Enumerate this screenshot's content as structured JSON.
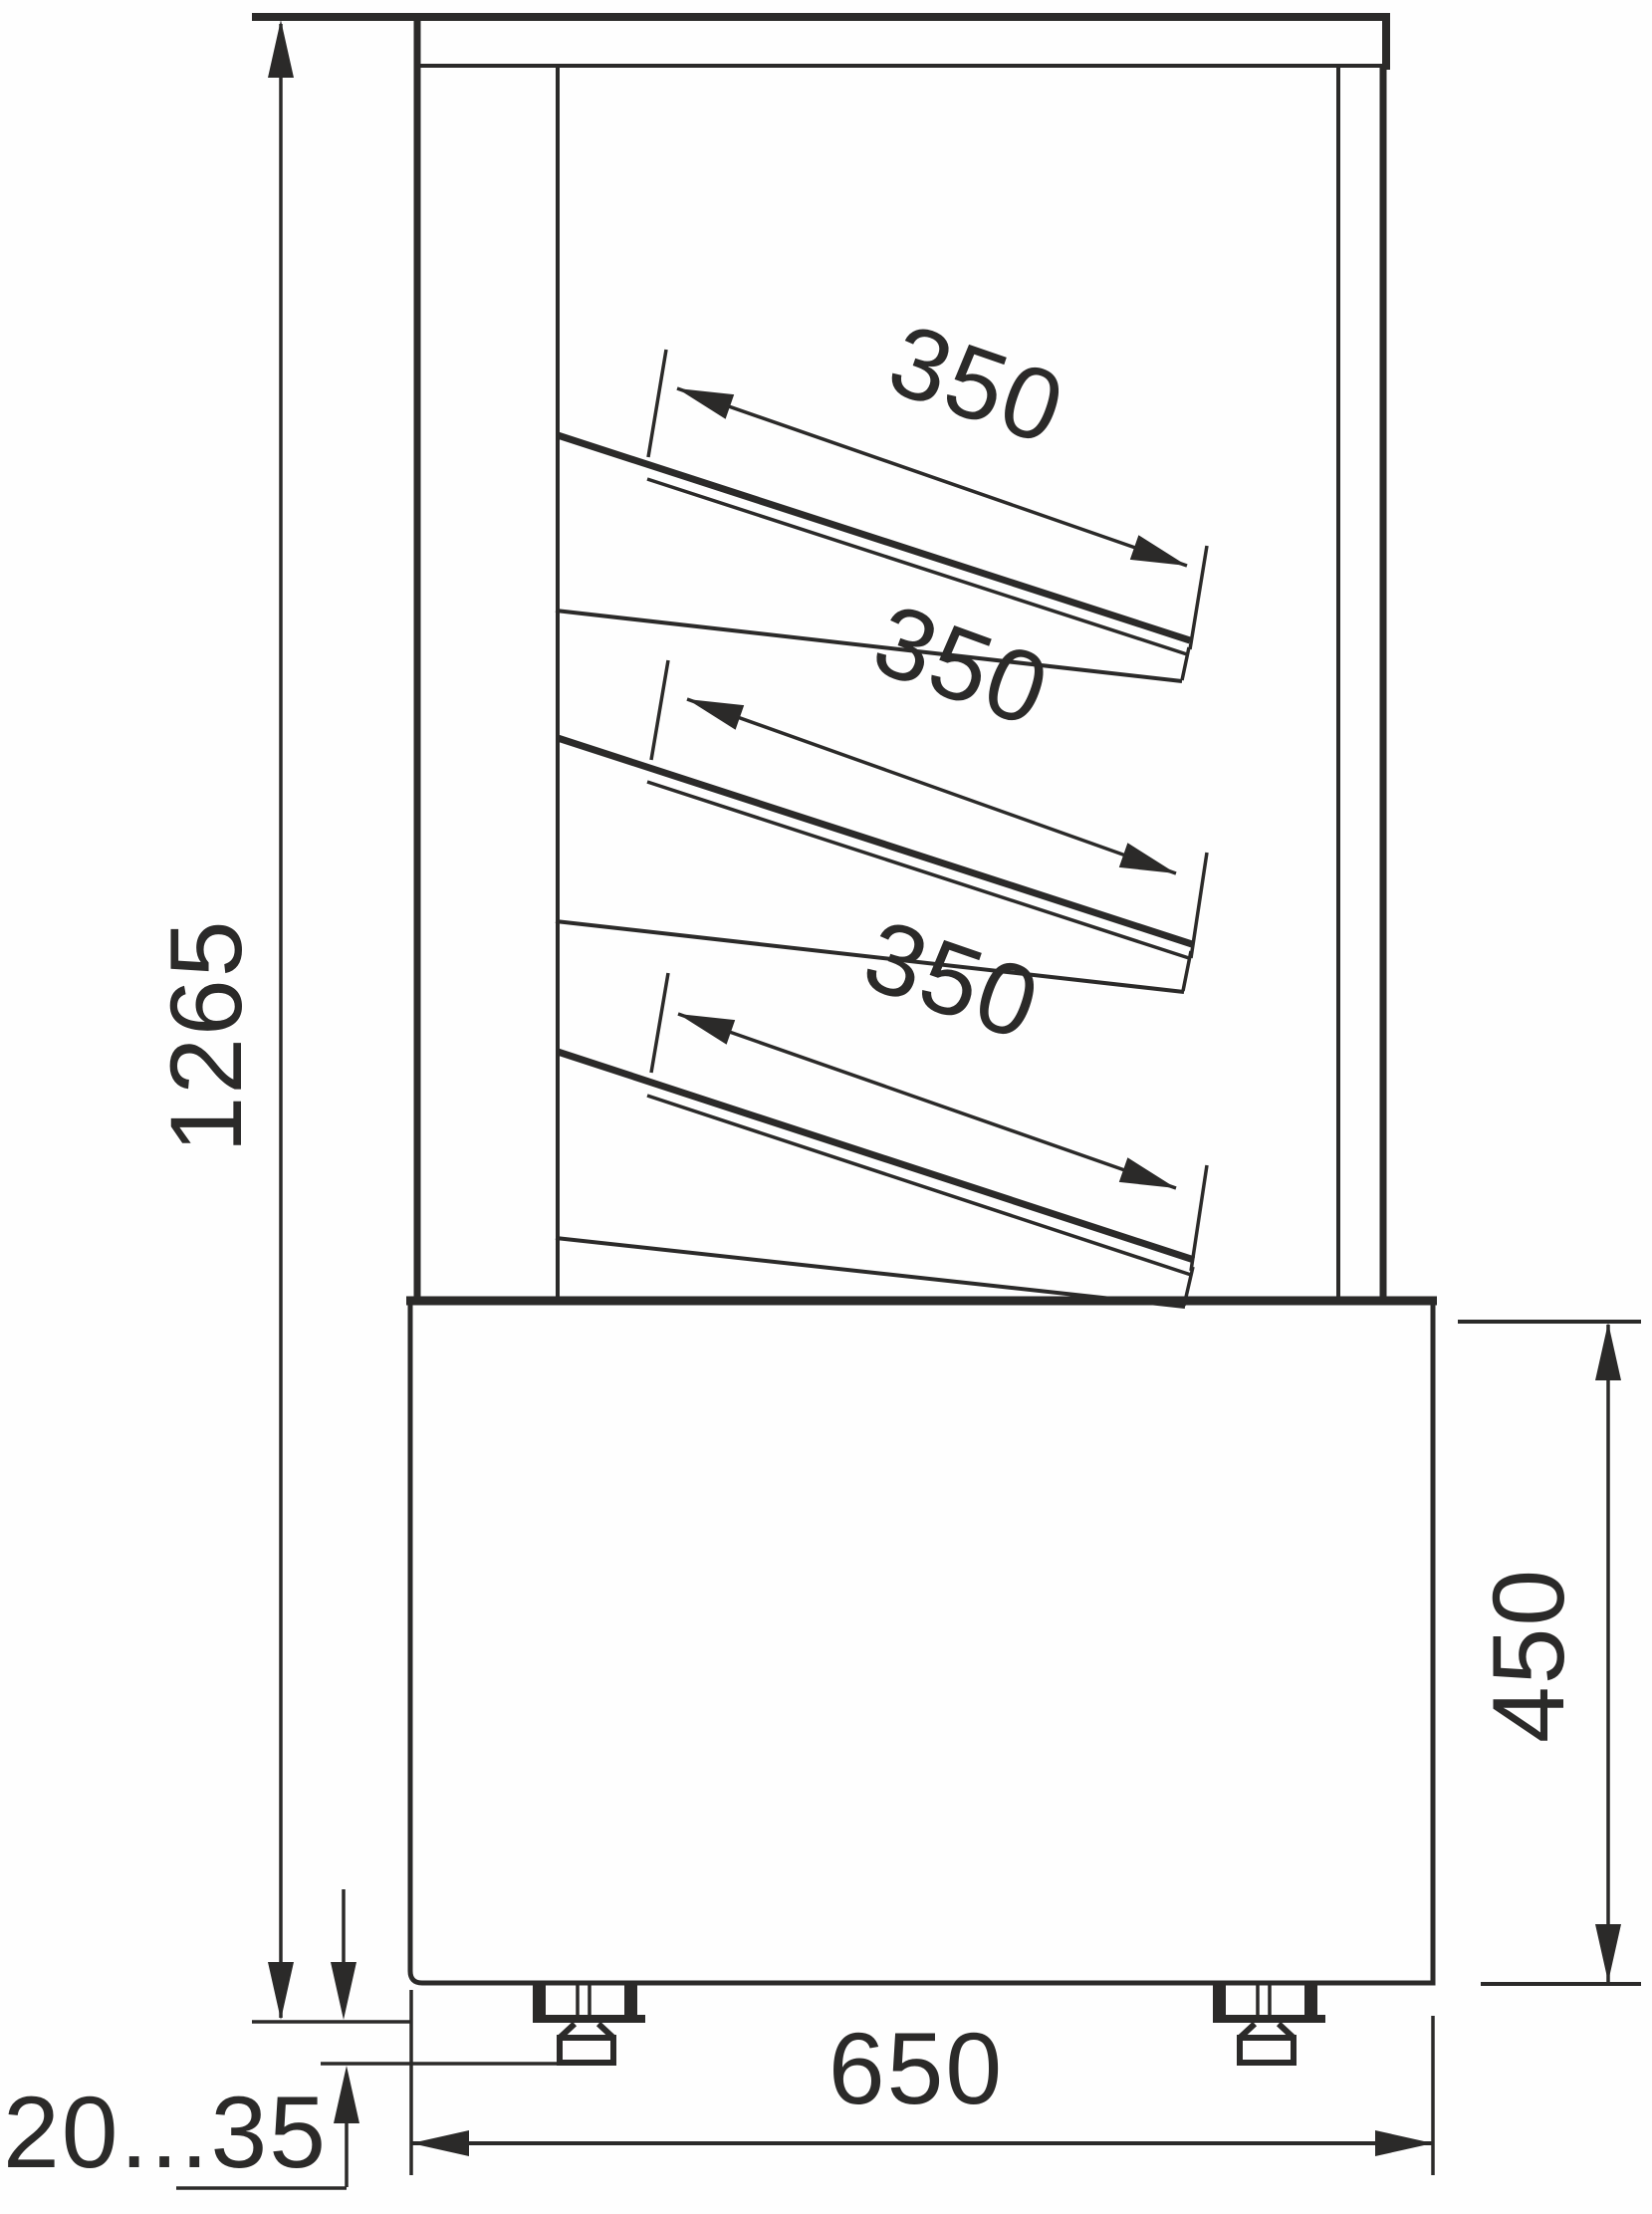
{
  "drawing": {
    "title": "refrigerated-display-case-side-view",
    "labels": {
      "overall_height": "1265",
      "shelf_depth_1": "350",
      "shelf_depth_2": "350",
      "shelf_depth_3": "350",
      "base_height": "450",
      "base_depth": "650",
      "foot_height_range": "20...35"
    },
    "colors": {
      "line": "#2b2a29",
      "background": "#fefefe"
    }
  }
}
